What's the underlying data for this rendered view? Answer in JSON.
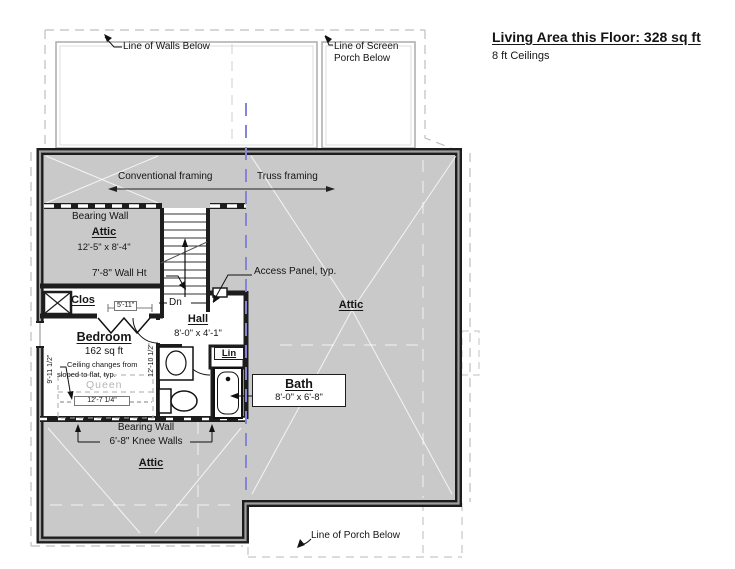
{
  "header": {
    "living_area": "Living Area this Floor: 328 sq ft",
    "ceilings": "8 ft Ceilings"
  },
  "callouts": {
    "walls_below": "Line of Walls Below",
    "screen_porch": "Line of Screen Porch Below",
    "porch_below": "Line of Porch Below",
    "access_panel": "Access Panel, typ.",
    "wall_height": "7'-8\" Wall Ht",
    "ceiling_note_line1": "Ceiling changes from",
    "ceiling_note_line2": "sloped to flat, typ.",
    "conventional_framing": "Conventional framing",
    "truss_framing": "Truss framing",
    "bearing_wall_upper": "Bearing Wall",
    "bearing_wall_lower": "Bearing Wall",
    "knee_walls": "6'-8\" Knee Walls",
    "stair_direction": "Dn",
    "bed_label": "Queen"
  },
  "rooms": {
    "attic_nw": {
      "name": "Attic",
      "dims": "12'-5\" x 8'-4\""
    },
    "attic_east": {
      "name": "Attic"
    },
    "attic_south": {
      "name": "Attic"
    },
    "closet": {
      "name": "Clos"
    },
    "hall": {
      "name": "Hall",
      "dims": "8'-0\" x 4'-1\""
    },
    "bedroom": {
      "name": "Bedroom",
      "area": "162 sq ft"
    },
    "linen": {
      "name": "Lin"
    },
    "bath": {
      "name": "Bath",
      "dims": "8'-0\" x 6'-8\""
    }
  },
  "dimensions": {
    "closet_width": "5'-11\"",
    "bedroom_width": "12'-7 1/4\"",
    "bedroom_depth": "9'-11 1/2\"",
    "hall_depth": "12'-10 1/2\""
  },
  "colors": {
    "matchline": "#8585d6",
    "attic_fill": "#c9c9c9",
    "wall": "#1d1d1d",
    "roof_line": "#ffffff"
  }
}
